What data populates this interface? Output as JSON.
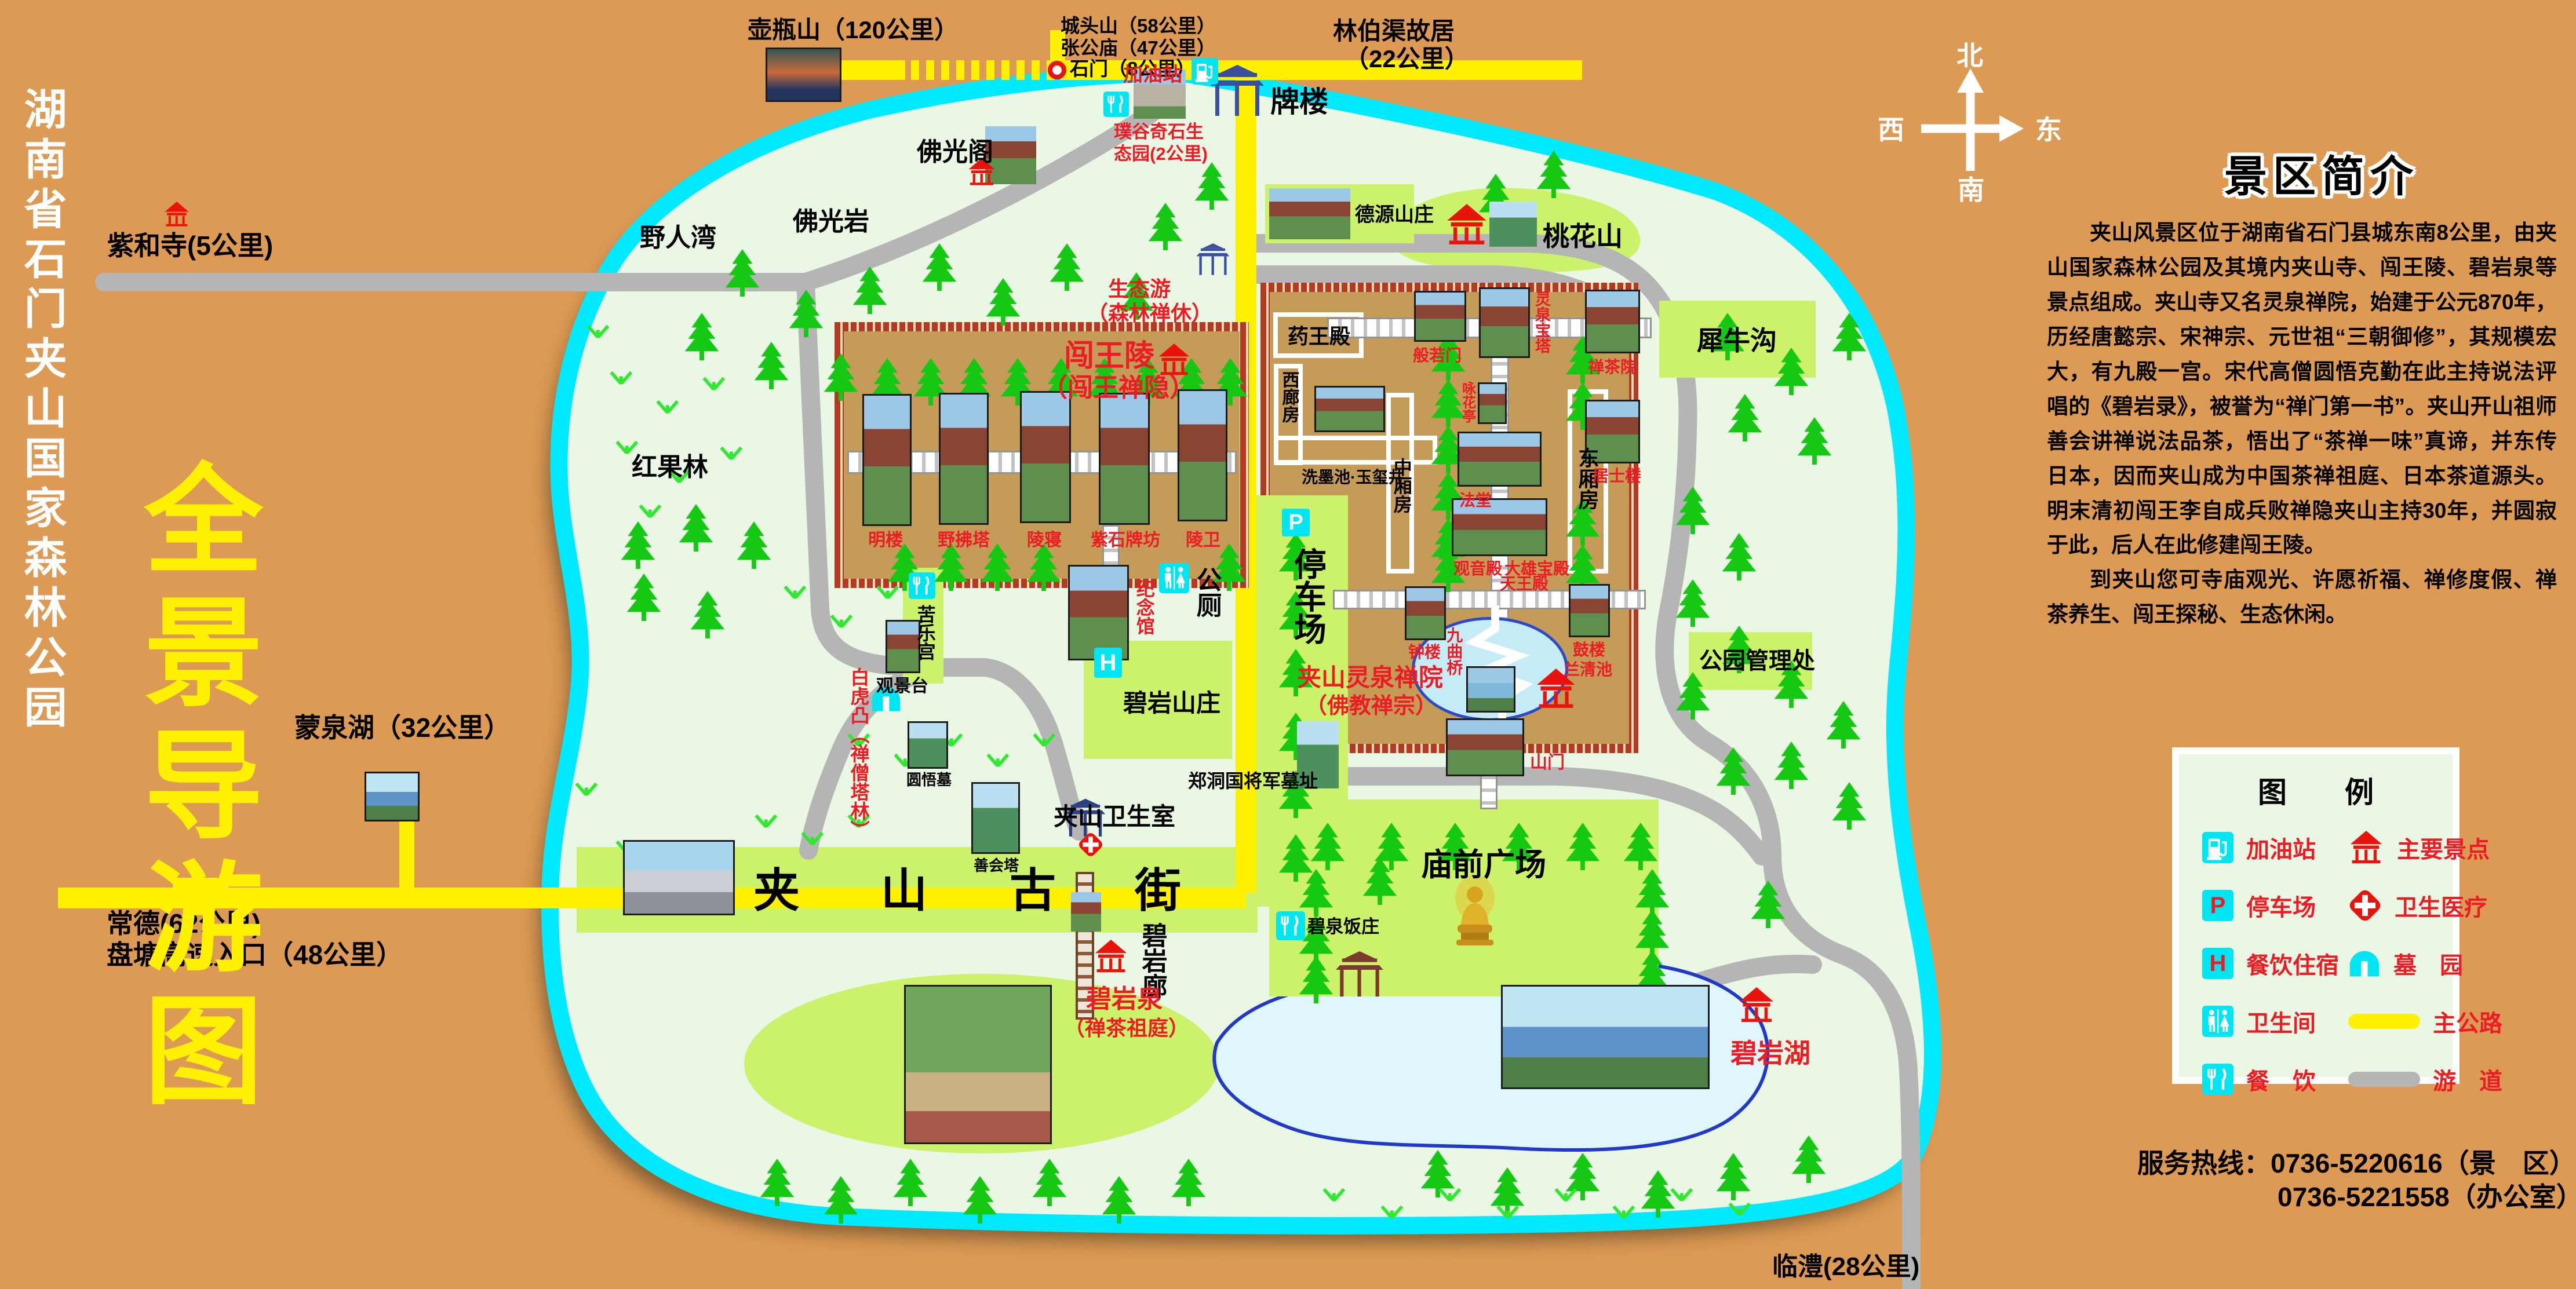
{
  "poster": {
    "park_name": "湖南省石门夹山国家森林公园",
    "map_title": "全景导游图"
  },
  "compass": {
    "north": "北",
    "east": "东",
    "south": "南",
    "west": "西"
  },
  "routes": {
    "huping": "壶瓶山（120公里）",
    "chengtou": "城头山（58公里）",
    "zhanggong": "张公庙（47公里）",
    "shimen": "石门（8公里）",
    "linboqu_1": "林伯渠故居",
    "linboqu_2": "（22公里）",
    "gas": "加油站",
    "pailou": "牌楼",
    "pugu_1": "璞谷奇石生",
    "pugu_2": "态园(2公里)",
    "zihesi": "紫和寺(5公里)",
    "mengquanhu": "蒙泉湖（32公里）",
    "changde": "常德(62公里)",
    "pantang": "盘塘高速入口（48公里）",
    "linli": "临澧(28公里)"
  },
  "areas": {
    "yerenwan": "野人湾",
    "foguangyan": "佛光岩",
    "foguangge": "佛光阁",
    "hongguolin": "红果林",
    "deyuan": "德源山庄",
    "taohuashan": "桃花山",
    "xiniugou": "犀牛沟",
    "shengtaiyou_1": "生态游",
    "shengtaiyou_2": "（森林禅休）",
    "guanlichu": "公园管理处",
    "miaoqian": "庙前广场",
    "biyan_shanzhuang": "碧岩山庄",
    "kulegong": "苦乐宫",
    "gongce": "公厕",
    "tingchechang": "停车场",
    "guanjingtai": "观景台",
    "baihutu": "白虎凸（禅僧塔林）",
    "yuanwumu": "圆悟墓",
    "shanhuita": "善会塔",
    "zhengdongguo": "郑洞国将军墓址",
    "weishengshi": "夹山卫生室",
    "gujie_1": "夹",
    "gujie_2": "山",
    "gujie_3": "古",
    "gujie_4": "街",
    "biyanlang": "碧岩廊",
    "biyanquan_1": "碧岩泉",
    "biyanquan_2": "（禅茶祖庭）",
    "biquan_fanzhuang": "碧泉饭庄",
    "biyanhu": "碧岩湖"
  },
  "cwl": {
    "t1": "闯王陵",
    "t2": "（闯王禅隐）",
    "minglou": "明楼",
    "yefuta": "野拂塔",
    "lingqin": "陵寝",
    "zishipaifang": "紫石牌坊",
    "lingwei": "陵卫",
    "jinianguan": "纪念馆"
  },
  "lq": {
    "t1": "夹山灵泉禅院",
    "t2": "（佛教禅宗）",
    "yaowang": "药王殿",
    "xilang": "西廊房",
    "ximo": "洗墨池·玉玺井",
    "zhongxiang": "中厢房",
    "dongxiang": "东厢房",
    "boruomen": "般若门",
    "baota": "灵泉宝塔",
    "yonghuating": "咏花亭",
    "fatang": "法堂",
    "guanyin": "观音殿",
    "daxiong": "大雄宝殿",
    "tianwang": "天王殿",
    "zhonglou": "钟楼",
    "gulou": "鼓楼",
    "jiuquqiao": "九曲桥",
    "lanqingchi": "兰清池",
    "chanchayuan": "禅茶院",
    "jushilou": "居士楼",
    "shanmen": "山门"
  },
  "intro": {
    "title": "景区简介",
    "p1": "夹山风景区位于湖南省石门县城东南8公里，由夹山国家森林公园及其境内夹山寺、闯王陵、碧岩泉等景点组成。夹山寺又名灵泉禅院，始建于公元870年，历经唐懿宗、宋神宗、元世祖“三朝御修”，其规模宏大，有九殿一宫。宋代高僧圆悟克勤在此主持说法评唱的《碧岩录》，被誉为“禅门第一书”。夹山开山祖师善会讲禅说法品茶，悟出了“茶禅一味”真谛，并东传日本，因而夹山成为中国茶禅祖庭、日本茶道源头。明末清初闯王李自成兵败禅隐夹山主持30年，并圆寂于此，后人在此修建闯王陵。",
    "p2": "到夹山您可寺庙观光、许愿祈福、禅修度假、禅茶养生、闯王探秘、生态休闲。"
  },
  "legend": {
    "title": "图　　例",
    "rows": [
      {
        "icon": "gas-station",
        "label": "加油站"
      },
      {
        "icon": "major-spot",
        "label": "主要景点"
      },
      {
        "icon": "parking",
        "label": "停车场"
      },
      {
        "icon": "medical",
        "label": "卫生医疗"
      },
      {
        "icon": "hotel-dining",
        "label": "餐饮住宿"
      },
      {
        "icon": "cemetery",
        "label": "墓　园"
      },
      {
        "icon": "toilet",
        "label": "卫生间"
      },
      {
        "icon": "main-road",
        "label": "主公路"
      },
      {
        "icon": "dining",
        "label": "餐　饮"
      },
      {
        "icon": "trail",
        "label": "游　道"
      }
    ]
  },
  "icons": {
    "p": "P",
    "h": "H"
  },
  "hotline": {
    "l1": "服务热线：0736-5220616（景　区）",
    "l2": "0736-5221558（办公室）"
  },
  "colors": {
    "background": "#DC9A55",
    "island": "#E9F7E4",
    "island_border": "#00E9FF",
    "main_road": "#FFF100",
    "trail": "#B5B5B5",
    "highlight_green": "#CCF26B",
    "temple_ground": "#C49B57",
    "accent_red": "#EC1C24",
    "icon_cyan": "#00E5F2"
  }
}
